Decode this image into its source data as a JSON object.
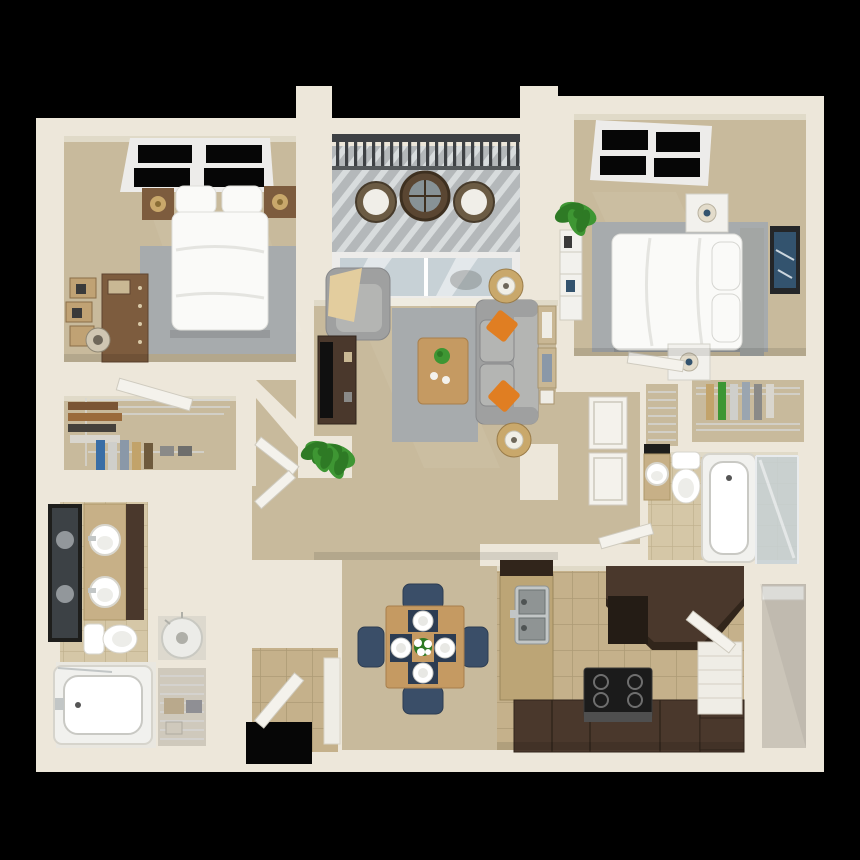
{
  "scene": {
    "type": "3d-birdseye-floorplan",
    "units": "two-bedroom-two-bath-apartment"
  },
  "colors": {
    "bg": "#000000",
    "wall": "#EDE7DA",
    "wallFace": "#E0DAC8",
    "baseboard": "#B9B0A0",
    "carpet": "#C8BA9C",
    "carpetDark": "#AFA288",
    "rug": "#A7ABAD",
    "tileBase": "#C5B18B",
    "tileGrout": "#AD9B76",
    "bathTileBase": "#D5C7A7",
    "bathTileGrout": "#BFAF8C",
    "espresso": "#4A382C",
    "espressoDark": "#31251B",
    "oak": "#C59A62",
    "oakDark": "#A87F4C",
    "wood": "#7D5C3E",
    "woodDark": "#5E4430",
    "furnWhite": "#F2F1ED",
    "bedWhite": "#FAFAF8",
    "bedShade": "#DEDEDA",
    "headboard": "#A3A6A4",
    "sofa": "#9FA0A0",
    "sofaLight": "#B4B5B3",
    "sofaDark": "#87888A",
    "orange": "#E07E22",
    "windowBlack": "#060606",
    "frameWhite": "#EDECEA",
    "railing": "#3E4144",
    "deckBase": "#B4B8BA",
    "deckStripe": "#D8DCDD",
    "glass": "#C7D1D6",
    "glassDark": "#9FB0B8",
    "plant": "#3E9633",
    "plantDark": "#2E7A25",
    "chairBlue": "#3A4E68",
    "chairBlueDark": "#2C3C52",
    "artBlue": "#33536E",
    "gold": "#C9A86B",
    "steel": "#C2C6C6",
    "steelDark": "#8F9494",
    "mirrorFrame": "#1E1E1C",
    "mirrorGlass": "#3C4145",
    "storageFloor": "#CBC5B9",
    "heaterWhite": "#ECECE8",
    "wire": "#D6D6D4",
    "doorWhite": "#F4F2EC",
    "doorEdge": "#CFCBBF",
    "throwTan": "#E3CD9E"
  },
  "floorplan": {
    "rooms": {
      "bedroom1": {
        "label": "Bedroom 1",
        "furniture": [
          "bed with two pillows",
          "nightstand with lamp (left)",
          "nightstand with lamp (right)",
          "dresser",
          "floating wall shelves",
          "floor lamp",
          "gray area rug",
          "black window"
        ]
      },
      "balcony": {
        "label": "Balcony",
        "furniture": [
          "metal railing",
          "wicker chair (left)",
          "wicker chair (right)",
          "round bistro table",
          "sliding glass door",
          "striped deck"
        ]
      },
      "bedroom2": {
        "label": "Bedroom 2",
        "furniture": [
          "bed with headboard",
          "two pillows",
          "nightstand with lamp (top)",
          "nightstand with lamp (bottom)",
          "blue wall art",
          "white bookshelf",
          "potted plant",
          "gray area rug",
          "black window"
        ]
      },
      "living": {
        "label": "Living Room",
        "furniture": [
          "gray sofa",
          "two orange throw pillows",
          "armchair with tan throw",
          "tv console",
          "flat tv",
          "oak coffee table with plant",
          "side table with lamp (top)",
          "side table with lamp (bottom)",
          "gray area rug",
          "potted plant",
          "leaning picture frames"
        ]
      },
      "dining": {
        "label": "Dining Area",
        "furniture": [
          "square oak table",
          "four blue chairs",
          "four place settings",
          "white flower centerpiece"
        ]
      },
      "kitchen": {
        "label": "Kitchen",
        "furniture": [
          "granite sink peninsula",
          "stainless double sink",
          "refrigerator / tall cabinet",
          "range with four burners",
          "espresso base counters",
          "pantry shelves with door"
        ]
      },
      "hallway": {
        "label": "Hallway",
        "furniture": [
          "louvered laundry doors"
        ]
      },
      "masterBath": {
        "label": "Master Bathroom",
        "furniture": [
          "double vanity with vessel sinks",
          "framed mirror",
          "toilet",
          "bathtub"
        ]
      },
      "closet1": {
        "label": "Walk-in Closet 1",
        "furniture": [
          "wire shelving",
          "hanging clothes",
          "closet door"
        ]
      },
      "utility": {
        "label": "Utility Closets",
        "furniture": [
          "water heater",
          "wire storage shelves"
        ]
      },
      "entry": {
        "label": "Entry",
        "furniture": [
          "front door opening",
          "open entry door",
          "tile floor",
          "partition wall"
        ]
      },
      "bath2": {
        "label": "Bathroom 2",
        "furniture": [
          "vanity with sink",
          "mirror",
          "toilet",
          "bathtub with glass shower"
        ]
      },
      "linen": {
        "label": "Linen Closet",
        "furniture": [
          "wire shelving"
        ]
      },
      "closet2": {
        "label": "Walk-in Closet 2",
        "furniture": [
          "wire shelving",
          "hanging clothes"
        ]
      },
      "storage": {
        "label": "Storage Room",
        "furniture": []
      }
    }
  }
}
